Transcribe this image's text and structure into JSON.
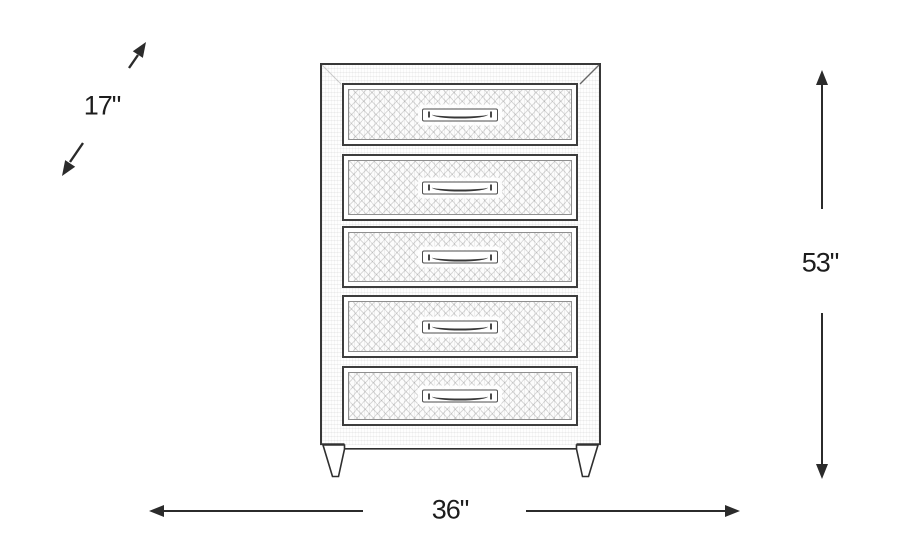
{
  "page": {
    "background_color": "#ffffff"
  },
  "diagram": {
    "type": "furniture-dimensions",
    "subject": "five-drawer chest, front-view line sketch",
    "drawer_count": 5,
    "dimensions": {
      "depth": "17\"",
      "height": "53\"",
      "width": "36\""
    },
    "arrows": {
      "depth": "diagonal double-headed arrow, upper-left",
      "height": "vertical double-headed arrow, right side",
      "width": "horizontal double-headed arrow, bottom"
    },
    "colors": {
      "dimension_line": "#2b2b2b",
      "sketch_outline": "#3d3d3d",
      "label_text": "#1d1d1d",
      "background": "#ffffff"
    }
  }
}
